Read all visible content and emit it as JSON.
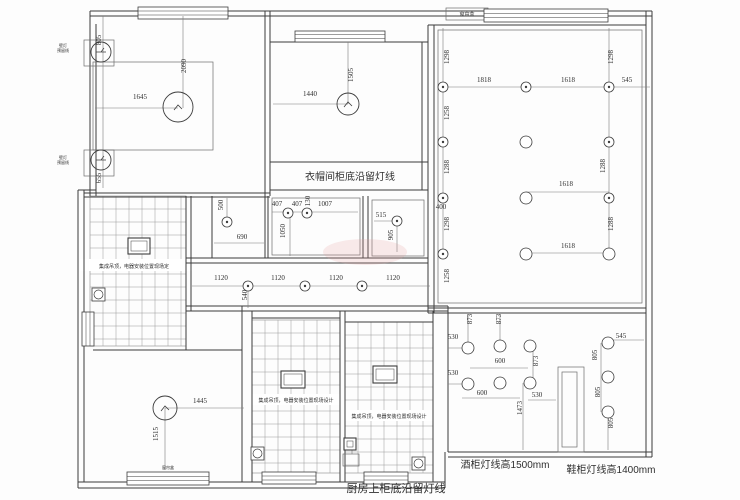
{
  "title": "ceiling-lighting-plan",
  "colors": {
    "wall": "#3c3c3c",
    "thin": "#6b6b6b",
    "dimline": "#7a7a7a",
    "grid": "#999999",
    "text": "#2f2f2f",
    "watermark": "#e89a9a"
  },
  "dims": [
    {
      "t": "805",
      "x": 101,
      "y": 40,
      "r": 1
    },
    {
      "t": "655",
      "x": 101,
      "y": 178,
      "r": 1
    },
    {
      "t": "2090",
      "x": 186,
      "y": 66,
      "r": 1
    },
    {
      "t": "1645",
      "x": 140,
      "y": 99,
      "r": 0
    },
    {
      "t": "1505",
      "x": 353,
      "y": 75,
      "r": 1
    },
    {
      "t": "1440",
      "x": 310,
      "y": 96,
      "r": 0
    },
    {
      "t": "1818",
      "x": 484,
      "y": 82,
      "r": 0
    },
    {
      "t": "1618",
      "x": 568,
      "y": 82,
      "r": 0
    },
    {
      "t": "545",
      "x": 627,
      "y": 82,
      "r": 0
    },
    {
      "t": "1298",
      "x": 449,
      "y": 57,
      "r": 1
    },
    {
      "t": "1258",
      "x": 449,
      "y": 113,
      "r": 1
    },
    {
      "t": "1288",
      "x": 449,
      "y": 167,
      "r": 1
    },
    {
      "t": "400",
      "x": 441,
      "y": 209,
      "r": 0
    },
    {
      "t": "1298",
      "x": 449,
      "y": 224,
      "r": 1
    },
    {
      "t": "1258",
      "x": 449,
      "y": 276,
      "r": 1
    },
    {
      "t": "1298",
      "x": 613,
      "y": 57,
      "r": 1
    },
    {
      "t": "1288",
      "x": 605,
      "y": 166,
      "r": 1
    },
    {
      "t": "1288",
      "x": 613,
      "y": 224,
      "r": 1
    },
    {
      "t": "1618",
      "x": 566,
      "y": 186,
      "r": 0
    },
    {
      "t": "1618",
      "x": 568,
      "y": 248,
      "r": 0
    },
    {
      "t": "407",
      "x": 277,
      "y": 206,
      "r": 0
    },
    {
      "t": "407",
      "x": 297,
      "y": 206,
      "r": 0
    },
    {
      "t": "130",
      "x": 310,
      "y": 201,
      "r": 1
    },
    {
      "t": "1007",
      "x": 325,
      "y": 206,
      "r": 0
    },
    {
      "t": "1050",
      "x": 285,
      "y": 231,
      "r": 1
    },
    {
      "t": "500",
      "x": 223,
      "y": 205,
      "r": 1
    },
    {
      "t": "690",
      "x": 242,
      "y": 239,
      "r": 0
    },
    {
      "t": "515",
      "x": 381,
      "y": 217,
      "r": 0
    },
    {
      "t": "905",
      "x": 393,
      "y": 235,
      "r": 1
    },
    {
      "t": "1120",
      "x": 221,
      "y": 280,
      "r": 0
    },
    {
      "t": "1120",
      "x": 278,
      "y": 280,
      "r": 0
    },
    {
      "t": "1120",
      "x": 336,
      "y": 280,
      "r": 0
    },
    {
      "t": "1120",
      "x": 393,
      "y": 280,
      "r": 0
    },
    {
      "t": "540",
      "x": 247,
      "y": 295,
      "r": 1
    },
    {
      "t": "1445",
      "x": 200,
      "y": 403,
      "r": 0
    },
    {
      "t": "1515",
      "x": 158,
      "y": 434,
      "r": 1
    },
    {
      "t": "530",
      "x": 453,
      "y": 339,
      "r": 0
    },
    {
      "t": "530",
      "x": 453,
      "y": 375,
      "r": 0
    },
    {
      "t": "600",
      "x": 500,
      "y": 363,
      "r": 0
    },
    {
      "t": "600",
      "x": 482,
      "y": 395,
      "r": 0
    },
    {
      "t": "530",
      "x": 537,
      "y": 397,
      "r": 0
    },
    {
      "t": "873",
      "x": 472,
      "y": 319,
      "r": 1
    },
    {
      "t": "873",
      "x": 501,
      "y": 319,
      "r": 1
    },
    {
      "t": "873",
      "x": 538,
      "y": 361,
      "r": 1
    },
    {
      "t": "1473",
      "x": 522,
      "y": 408,
      "r": 1
    },
    {
      "t": "545",
      "x": 621,
      "y": 338,
      "r": 0
    },
    {
      "t": "805",
      "x": 597,
      "y": 355,
      "r": 1
    },
    {
      "t": "805",
      "x": 600,
      "y": 392,
      "r": 1
    },
    {
      "t": "805",
      "x": 613,
      "y": 423,
      "r": 1
    }
  ],
  "notes": [
    {
      "t": "衣帽间柜底沿留灯线",
      "x": 350,
      "y": 180,
      "s": 10
    },
    {
      "t": "厨房上柜底沿留灯线",
      "x": 396,
      "y": 492,
      "s": 11
    },
    {
      "t": "酒柜灯线高1500mm",
      "x": 505,
      "y": 468,
      "s": 10
    },
    {
      "t": "鞋柜灯线高1400mm",
      "x": 611,
      "y": 473,
      "s": 10
    },
    {
      "t": "集成吊顶，电器安装位置现场定",
      "x": 134,
      "y": 268,
      "s": 5
    },
    {
      "t": "集成吊顶，电器安装位置现场设计",
      "x": 296,
      "y": 402,
      "s": 5
    },
    {
      "t": "集成吊顶，电器安装位置现场设计",
      "x": 389,
      "y": 418,
      "s": 5
    },
    {
      "t": "窗帘盒",
      "x": 467,
      "y": 16,
      "s": 5
    },
    {
      "t": "窗帘盒",
      "x": 168,
      "y": 469,
      "s": 4
    },
    {
      "t": "壁灯",
      "x": 63,
      "y": 47,
      "s": 4
    },
    {
      "t": "预留线",
      "x": 63,
      "y": 52,
      "s": 4
    },
    {
      "t": "壁灯",
      "x": 63,
      "y": 159,
      "s": 4
    },
    {
      "t": "预留线",
      "x": 63,
      "y": 164,
      "s": 4
    }
  ],
  "walls": [
    [
      90,
      11,
      652,
      11
    ],
    [
      90,
      16,
      652,
      16
    ],
    [
      90,
      11,
      90,
      196
    ],
    [
      96,
      24,
      96,
      196
    ],
    [
      78,
      190,
      78,
      488
    ],
    [
      84,
      190,
      84,
      482
    ],
    [
      78,
      190,
      96,
      190
    ],
    [
      78,
      482,
      445,
      482
    ],
    [
      78,
      488,
      445,
      488
    ],
    [
      646,
      11,
      646,
      457
    ],
    [
      652,
      11,
      652,
      457
    ],
    [
      448,
      452,
      652,
      452
    ],
    [
      448,
      457,
      652,
      457
    ],
    [
      445,
      452,
      445,
      488
    ],
    [
      265,
      11,
      265,
      196
    ],
    [
      270,
      11,
      270,
      196
    ],
    [
      84,
      193,
      270,
      193
    ],
    [
      84,
      197,
      270,
      197
    ],
    [
      270,
      42,
      428,
      42
    ],
    [
      270,
      162,
      428,
      162
    ],
    [
      270,
      190,
      428,
      190
    ],
    [
      422,
      42,
      422,
      190
    ],
    [
      428,
      25,
      428,
      313
    ],
    [
      434,
      25,
      434,
      313
    ],
    [
      428,
      25,
      646,
      25
    ],
    [
      428,
      308,
      646,
      308
    ],
    [
      428,
      313,
      646,
      313
    ],
    [
      186,
      258,
      428,
      258
    ],
    [
      186,
      263,
      428,
      263
    ],
    [
      186,
      306,
      448,
      306
    ],
    [
      186,
      311,
      448,
      311
    ],
    [
      186,
      196,
      186,
      350
    ],
    [
      191,
      196,
      191,
      311
    ],
    [
      212,
      196,
      212,
      258
    ],
    [
      265,
      196,
      265,
      258
    ],
    [
      268,
      196,
      268,
      258
    ],
    [
      363,
      196,
      363,
      258
    ],
    [
      368,
      196,
      368,
      258
    ],
    [
      93,
      350,
      242,
      350
    ],
    [
      242,
      306,
      242,
      482
    ],
    [
      252,
      311,
      252,
      482
    ],
    [
      340,
      311,
      340,
      482
    ],
    [
      345,
      311,
      345,
      482
    ],
    [
      433,
      311,
      433,
      482
    ],
    [
      252,
      318,
      340,
      318
    ],
    [
      345,
      322,
      433,
      322
    ],
    [
      448,
      306,
      448,
      452
    ]
  ],
  "thin_rects": [
    [
      93,
      62,
      120,
      88
    ],
    [
      84,
      40,
      30,
      26
    ],
    [
      84,
      150,
      30,
      26
    ],
    [
      438,
      30,
      204,
      273
    ],
    [
      272,
      198,
      88,
      57
    ],
    [
      372,
      200,
      52,
      56
    ],
    [
      558,
      367,
      26,
      85
    ],
    [
      562,
      372,
      15,
      75
    ],
    [
      343,
      454,
      16,
      12
    ],
    [
      446,
      8,
      42,
      12
    ]
  ],
  "dim_lines": [
    [
      103,
      16,
      103,
      188
    ],
    [
      95,
      108,
      178,
      108
    ],
    [
      183,
      16,
      183,
      108
    ],
    [
      348,
      42,
      348,
      104
    ],
    [
      273,
      104,
      348,
      104
    ],
    [
      438,
      87,
      650,
      87
    ],
    [
      443,
      28,
      443,
      258
    ],
    [
      609,
      28,
      609,
      258
    ],
    [
      526,
      192,
      609,
      192
    ],
    [
      530,
      253,
      612,
      253
    ],
    [
      192,
      286,
      430,
      286
    ],
    [
      248,
      286,
      248,
      308
    ],
    [
      227,
      198,
      227,
      226
    ],
    [
      214,
      243,
      264,
      243
    ],
    [
      272,
      212,
      358,
      212
    ],
    [
      290,
      212,
      290,
      256
    ],
    [
      374,
      221,
      397,
      221
    ],
    [
      397,
      221,
      397,
      252
    ],
    [
      165,
      408,
      244,
      408
    ],
    [
      165,
      408,
      165,
      470
    ],
    [
      468,
      315,
      468,
      348
    ],
    [
      500,
      315,
      500,
      348
    ],
    [
      533,
      348,
      533,
      383
    ],
    [
      523,
      383,
      523,
      450
    ],
    [
      601,
      343,
      601,
      412
    ],
    [
      608,
      412,
      608,
      450
    ],
    [
      448,
      348,
      468,
      348
    ],
    [
      448,
      384,
      468,
      384
    ],
    [
      470,
      368,
      528,
      368
    ],
    [
      462,
      398,
      520,
      398
    ],
    [
      528,
      400,
      556,
      400
    ],
    [
      608,
      340,
      644,
      340
    ],
    [
      352,
      443,
      352,
      454
    ]
  ],
  "grids": [
    {
      "x": 90,
      "y": 196,
      "w": 96,
      "h": 150,
      "cell": 13
    },
    {
      "x": 252,
      "y": 320,
      "w": 88,
      "h": 153,
      "cell": 13
    },
    {
      "x": 345,
      "y": 322,
      "w": 88,
      "h": 151,
      "cell": 13
    }
  ],
  "white_bands": [
    [
      80,
      259,
      112,
      12
    ],
    [
      252,
      394,
      88,
      11
    ],
    [
      345,
      410,
      88,
      11
    ]
  ],
  "windows": [
    {
      "x": 138,
      "y": 7,
      "w": 90,
      "h": 12,
      "o": "h"
    },
    {
      "x": 295,
      "y": 31,
      "w": 90,
      "h": 11,
      "o": "h"
    },
    {
      "x": 484,
      "y": 9,
      "w": 124,
      "h": 13,
      "o": "h"
    },
    {
      "x": 82,
      "y": 312,
      "w": 12,
      "h": 34,
      "o": "v"
    },
    {
      "x": 127,
      "y": 472,
      "w": 82,
      "h": 13,
      "o": "h"
    },
    {
      "x": 262,
      "y": 472,
      "w": 54,
      "h": 12,
      "o": "h"
    },
    {
      "x": 364,
      "y": 472,
      "w": 44,
      "h": 12,
      "o": "h"
    }
  ],
  "lights": {
    "ceiling": [
      [
        178,
        107,
        15
      ],
      [
        348,
        104,
        11
      ],
      [
        165,
        408,
        12
      ]
    ],
    "wall_lamp": [
      [
        101,
        52,
        10
      ],
      [
        101,
        160,
        10
      ]
    ],
    "spot_dot": [
      [
        443,
        87
      ],
      [
        443,
        142
      ],
      [
        443,
        198
      ],
      [
        443,
        254
      ],
      [
        526,
        87
      ],
      [
        609,
        87
      ],
      [
        609,
        142
      ],
      [
        609,
        198
      ],
      [
        248,
        286
      ],
      [
        305,
        286
      ],
      [
        362,
        286
      ],
      [
        288,
        213
      ],
      [
        307,
        213
      ],
      [
        397,
        221
      ],
      [
        227,
        222
      ]
    ],
    "spot": [
      [
        526,
        142
      ],
      [
        526,
        198
      ],
      [
        526,
        254
      ],
      [
        609,
        254
      ],
      [
        468,
        348
      ],
      [
        500,
        346
      ],
      [
        530,
        346
      ],
      [
        468,
        384
      ],
      [
        500,
        383
      ],
      [
        530,
        383
      ],
      [
        608,
        343
      ],
      [
        608,
        377
      ],
      [
        608,
        412
      ]
    ],
    "square_fixture": [
      [
        128,
        238,
        22,
        16
      ],
      [
        281,
        371,
        24,
        17
      ],
      [
        373,
        366,
        24,
        17
      ],
      [
        344,
        438,
        12,
        12
      ]
    ],
    "fan": [
      [
        92,
        288,
        13
      ],
      [
        251,
        447,
        13
      ],
      [
        412,
        457,
        13
      ]
    ]
  },
  "watermark": {
    "x": 365,
    "y": 252,
    "rx": 42,
    "ry": 13
  }
}
